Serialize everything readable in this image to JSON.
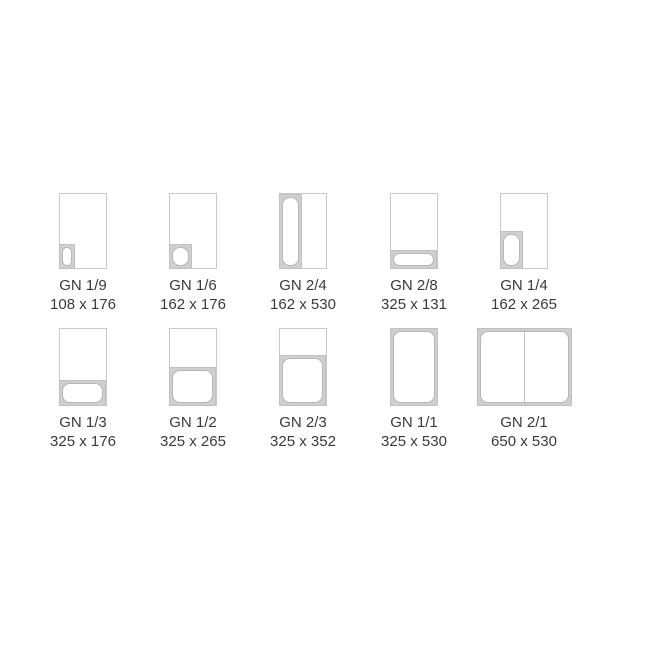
{
  "title": "Gastronorm (GN) container size chart",
  "colors": {
    "background": "#ffffff",
    "frame_border": "#c9c9c9",
    "pan_band_fill": "#cfcfcf",
    "pan_outline": "#b6b6b6",
    "text": "#3a3a3a"
  },
  "items": [
    {
      "code": "GN 1/9",
      "dimensions": "108 x 176"
    },
    {
      "code": "GN 1/6",
      "dimensions": "162 x 176"
    },
    {
      "code": "GN 2/4",
      "dimensions": "162 x 530"
    },
    {
      "code": "GN 2/8",
      "dimensions": "325 x 131"
    },
    {
      "code": "GN 1/4",
      "dimensions": "162 x 265"
    },
    {
      "code": "GN 1/3",
      "dimensions": "325 x 176"
    },
    {
      "code": "GN 1/2",
      "dimensions": "325 x 265"
    },
    {
      "code": "GN 2/3",
      "dimensions": "325 x 352"
    },
    {
      "code": "GN 1/1",
      "dimensions": "325 x 530"
    },
    {
      "code": "GN 2/1",
      "dimensions": "650 x 530"
    }
  ]
}
